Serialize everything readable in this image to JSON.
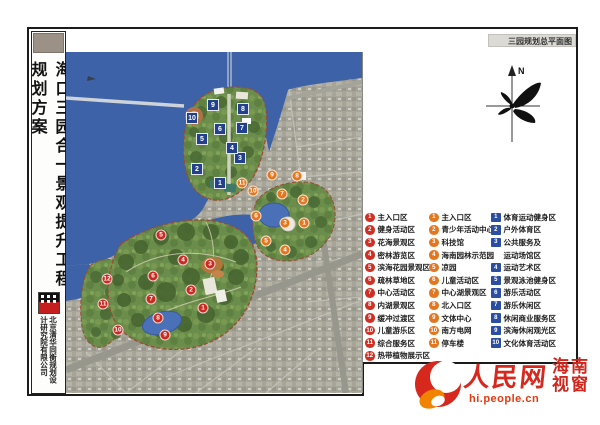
{
  "header": {
    "plan_title": "三园规划总平面图"
  },
  "sidebar": {
    "title": "海口三园合一景观提升工程规划方案",
    "company": "北京清华同衡规划设计研究院有限公司"
  },
  "compass": {
    "label": "N"
  },
  "legend": {
    "columns": [
      {
        "style": "red-circle",
        "items": [
          {
            "n": "1",
            "label": "主入口区"
          },
          {
            "n": "2",
            "label": "健身活动区"
          },
          {
            "n": "3",
            "label": "花海景观区"
          },
          {
            "n": "4",
            "label": "密林游览区"
          },
          {
            "n": "5",
            "label": "滨海花园景观区"
          },
          {
            "n": "6",
            "label": "疏林草地区"
          },
          {
            "n": "7",
            "label": "中心活动区"
          },
          {
            "n": "8",
            "label": "内湖景观区"
          },
          {
            "n": "9",
            "label": "缓冲过渡区"
          },
          {
            "n": "10",
            "label": "儿童游乐区"
          },
          {
            "n": "11",
            "label": "综合服务区"
          },
          {
            "n": "12",
            "label": "热带植物展示区"
          }
        ]
      },
      {
        "style": "orange-circle",
        "items": [
          {
            "n": "1",
            "label": "主入口区"
          },
          {
            "n": "2",
            "label": "青少年活动中心"
          },
          {
            "n": "3",
            "label": "科技馆"
          },
          {
            "n": "4",
            "label": "海南园林示范园"
          },
          {
            "n": "5",
            "label": "凉园"
          },
          {
            "n": "6",
            "label": "儿童活动区"
          },
          {
            "n": "7",
            "label": "中心湖景观区"
          },
          {
            "n": "8",
            "label": "北入口区"
          },
          {
            "n": "9",
            "label": "文体中心"
          },
          {
            "n": "10",
            "label": "南方电网"
          },
          {
            "n": "11",
            "label": "停车楼"
          }
        ]
      },
      {
        "style": "blue-square",
        "items": [
          {
            "n": "1",
            "label": "体育运动健身区"
          },
          {
            "n": "2",
            "label": "户外体育区"
          },
          {
            "n": "3",
            "label": "公共服务及",
            "label2": "运动场馆区"
          },
          {
            "n": "4",
            "label": "运动艺术区"
          },
          {
            "n": "5",
            "label": "景观泳池健身区"
          },
          {
            "n": "6",
            "label": "游乐活动区"
          },
          {
            "n": "7",
            "label": "游乐休闲区"
          },
          {
            "n": "8",
            "label": "休闲商业服务区"
          },
          {
            "n": "9",
            "label": "滨海休闲观光区"
          },
          {
            "n": "10",
            "label": "文化体育活动区"
          }
        ]
      }
    ]
  },
  "map": {
    "markers": {
      "blue": [
        {
          "n": "1",
          "x": 154,
          "y": 131
        },
        {
          "n": "2",
          "x": 131,
          "y": 117
        },
        {
          "n": "3",
          "x": 174,
          "y": 106
        },
        {
          "n": "4",
          "x": 166,
          "y": 96
        },
        {
          "n": "5",
          "x": 136,
          "y": 87
        },
        {
          "n": "6",
          "x": 154,
          "y": 77
        },
        {
          "n": "7",
          "x": 176,
          "y": 76
        },
        {
          "n": "8",
          "x": 177,
          "y": 57
        },
        {
          "n": "9",
          "x": 147,
          "y": 53
        },
        {
          "n": "10",
          "x": 126,
          "y": 66
        }
      ],
      "orange": [
        {
          "n": "1",
          "x": 238,
          "y": 171
        },
        {
          "n": "2",
          "x": 237,
          "y": 148
        },
        {
          "n": "3",
          "x": 219,
          "y": 171
        },
        {
          "n": "4",
          "x": 219,
          "y": 198
        },
        {
          "n": "5",
          "x": 200,
          "y": 189
        },
        {
          "n": "6",
          "x": 190,
          "y": 164
        },
        {
          "n": "7",
          "x": 216,
          "y": 142
        },
        {
          "n": "8",
          "x": 231,
          "y": 124
        },
        {
          "n": "9",
          "x": 206,
          "y": 123
        },
        {
          "n": "10",
          "x": 187,
          "y": 139
        },
        {
          "n": "11",
          "x": 176,
          "y": 131
        }
      ],
      "red": [
        {
          "n": "1",
          "x": 137,
          "y": 256
        },
        {
          "n": "2",
          "x": 125,
          "y": 238
        },
        {
          "n": "3",
          "x": 144,
          "y": 212
        },
        {
          "n": "4",
          "x": 117,
          "y": 208
        },
        {
          "n": "5",
          "x": 95,
          "y": 183
        },
        {
          "n": "6",
          "x": 87,
          "y": 224
        },
        {
          "n": "7",
          "x": 85,
          "y": 247
        },
        {
          "n": "8",
          "x": 92,
          "y": 266
        },
        {
          "n": "9",
          "x": 99,
          "y": 283
        },
        {
          "n": "10",
          "x": 52,
          "y": 278
        },
        {
          "n": "11",
          "x": 37,
          "y": 252
        },
        {
          "n": "12",
          "x": 41,
          "y": 227
        }
      ]
    }
  },
  "footer": {
    "brand": "人民网",
    "url": "hi.people.cn",
    "region_line1": "海南",
    "region_line2": "视窗"
  },
  "colors": {
    "sea": "#3d62a8",
    "park_green": "#6b8d4c",
    "urban": "#a7a599",
    "red_marker": "#cc2a20",
    "orange_marker": "#e4761f",
    "blue_marker": "#21418f",
    "brand_red": "#d7281e"
  }
}
